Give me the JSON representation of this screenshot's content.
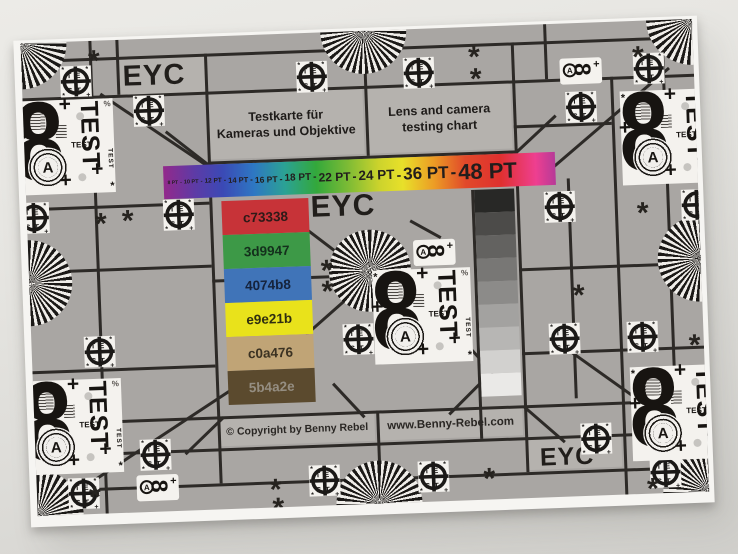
{
  "texts": {
    "eyc": "EYC",
    "title_de": [
      "Testkarte für",
      "Kameras und Objektive"
    ],
    "title_en": [
      "Lens and camera",
      "testing chart"
    ],
    "copyright": "© Copyright by Benny Rebel",
    "website": "www.Benny-Rebel.com"
  },
  "rainbow": {
    "separator": "-",
    "labels": [
      "8 PT",
      "10 PT",
      "12 PT",
      "14 PT",
      "16 PT",
      "18 PT",
      "22 PT",
      "24 PT",
      "36 PT",
      "48 PT"
    ],
    "gradient": [
      "#93298b 0%",
      "#5d3ba6 8%",
      "#3b49b5 15%",
      "#2e77c3 23%",
      "#2ba294 31%",
      "#33a83b 39%",
      "#7cbb35 47%",
      "#ccd32c 55%",
      "#e8e02a 61%",
      "#ec9c25 69%",
      "#e1492a 77%",
      "#e0302f 86%",
      "#ee3f90 95%",
      "#b63a98 100%"
    ]
  },
  "patches": [
    {
      "label": "c73338",
      "hex": "#c73338",
      "label_color": "#2e1a18"
    },
    {
      "label": "3d9947",
      "hex": "#3d9947",
      "label_color": "#14301c"
    },
    {
      "label": "4074b8",
      "hex": "#4074b8",
      "label_color": "#15233c"
    },
    {
      "label": "e9e21b",
      "hex": "#e9e21b",
      "label_color": "#2f2d10"
    },
    {
      "label": "c0a476",
      "hex": "#c0a476",
      "label_color": "#3b3222"
    },
    {
      "label": "5b4a2e",
      "hex": "#5b4a2e",
      "label_color": "#958e82"
    }
  ],
  "grayscale_steps": [
    "#282826",
    "#4c4b49",
    "#636260",
    "#787775",
    "#8c8b89",
    "#a3a2a0",
    "#b7b6b4",
    "#d2d1cf",
    "#eae9e7"
  ],
  "target_block": {
    "digit": "8",
    "letter": "A",
    "test": "TEST"
  },
  "crosshair_target": {
    "top": "TE",
    "bottom": "ST"
  },
  "marks": {
    "asterisk": "*",
    "plus": "+",
    "percent": "%"
  },
  "colors": {
    "paper": "#f6f5f2",
    "chart_bg": "#a9a6a3",
    "cell_bg": "#b5b2ae",
    "line": "#2d2a27",
    "ink": "#1b1917",
    "ray_dark": "#1b1917",
    "ray_light": "#efede9"
  }
}
